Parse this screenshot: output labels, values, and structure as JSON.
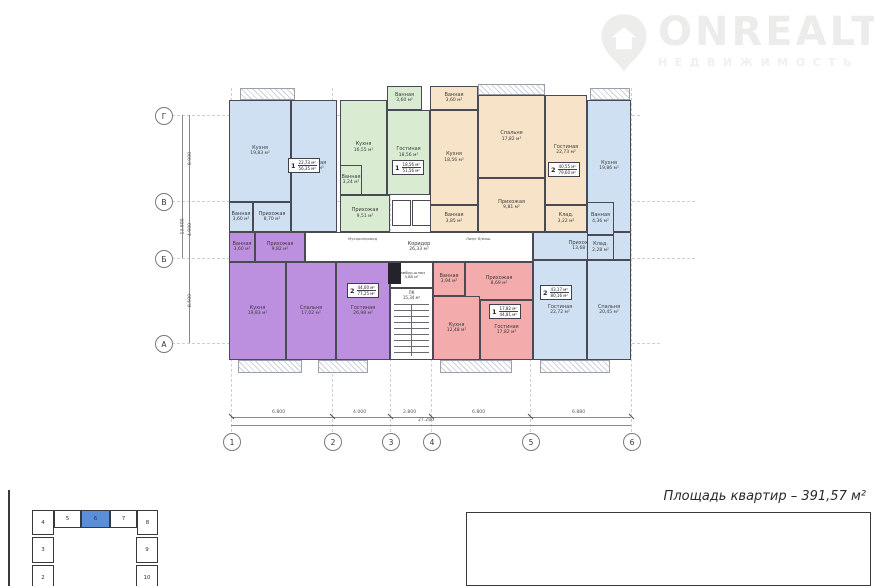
{
  "watermark": {
    "brand": "ONREALT",
    "subtitle": "НЕДВИЖИМОСТЬ",
    "color": "#ececea"
  },
  "plan": {
    "wall_color": "#4a4a55",
    "axes_cols": [
      "1",
      "2",
      "3",
      "4",
      "5",
      "6"
    ],
    "axes_rows": [
      "Г",
      "В",
      "Б",
      "А"
    ],
    "dims_bottom": [
      "6.800",
      "4.000",
      "2.800",
      "6.800",
      "6.880"
    ],
    "dim_bottom_total": "27.280",
    "dims_left": [
      "8.900",
      "4.900",
      "8.500"
    ],
    "dim_left_total": "13.800",
    "apartments": {
      "a1": {
        "color": "#cfe0f3",
        "tag": {
          "num": "1",
          "living": "22,73 м²",
          "total": "56,35 м²"
        },
        "rooms": {
          "kitchen": {
            "name": "Кухня",
            "area": "19,83 м²"
          },
          "living": {
            "name": "Гостиная",
            "area": "22,73 м²"
          },
          "hall": {
            "name": "Прихожая",
            "area": "8,70 м²"
          },
          "bath": {
            "name": "Ванная",
            "area": "3,60 м²"
          }
        }
      },
      "a2": {
        "color": "#d9ecd2",
        "tag": {
          "num": "1",
          "living": "18,56 м²",
          "total": "51,56 м²"
        },
        "rooms": {
          "bath_top": {
            "name": "Ванная",
            "area": "3,60 м²"
          },
          "kitchen": {
            "name": "Кухня",
            "area": "16,55 м²"
          },
          "living": {
            "name": "Гостиная",
            "area": "18,56 м²"
          },
          "bath": {
            "name": "Ванная",
            "area": "3,24 м²"
          },
          "hall": {
            "name": "Прихожая",
            "area": "9,51 м²"
          }
        }
      },
      "a3": {
        "color": "#f7e3c7",
        "tag": {
          "num": "2",
          "living": "40,55 м²",
          "total": "79,60 м²"
        },
        "rooms": {
          "bath_top": {
            "name": "Ванная",
            "area": "3,60 м²"
          },
          "kitchen": {
            "name": "Кухня",
            "area": "18,56 м²"
          },
          "bedroom": {
            "name": "Спальня",
            "area": "17,82 м²"
          },
          "living": {
            "name": "Гостиная",
            "area": "22,73 м²"
          },
          "hall": {
            "name": "Прихожая",
            "area": "9,81 м²"
          },
          "bath": {
            "name": "Ванная",
            "area": "3,85 м²"
          },
          "storage": {
            "name": "Клад.",
            "area": "3,22 м²"
          }
        }
      },
      "a4": {
        "color": "#cfe0f3",
        "tag": {
          "num": "2",
          "living": "43,17 м²",
          "total": "80,16 м²"
        },
        "rooms": {
          "kitchen": {
            "name": "Кухня",
            "area": "19,86 м²"
          },
          "bath": {
            "name": "Ванная",
            "area": "4,36 м²"
          },
          "storage": {
            "name": "Клад.",
            "area": "2,28 м²"
          },
          "hall": {
            "name": "Прихожая",
            "area": "13,68 м²"
          },
          "living": {
            "name": "Гостиная",
            "area": "22,72 м²"
          },
          "bedroom": {
            "name": "Спальня",
            "area": "20,45 м²"
          }
        }
      },
      "a5": {
        "color": "#bd8fdf",
        "tag": {
          "num": "2",
          "living": "44,00 м²",
          "total": "77,25 м²"
        },
        "rooms": {
          "bath": {
            "name": "Ванная",
            "area": "3,60 м²"
          },
          "hall": {
            "name": "Прихожая",
            "area": "9,82 м²"
          },
          "kitchen": {
            "name": "Кухня",
            "area": "19,83 м²"
          },
          "bedroom": {
            "name": "Спальня",
            "area": "17,02 м²"
          },
          "living": {
            "name": "Гостиная",
            "area": "26,98 м²"
          }
        }
      },
      "a6": {
        "color": "#f3abab",
        "tag": {
          "num": "1",
          "living": "17,82 м²",
          "total": "44,81 м²"
        },
        "rooms": {
          "bath": {
            "name": "Ванная",
            "area": "3,94 м²"
          },
          "hall": {
            "name": "Прихожая",
            "area": "8,69 м²"
          },
          "kitchen": {
            "name": "Кухня",
            "area": "12,48 м²"
          },
          "living": {
            "name": "Гостиная",
            "area": "17,82 м²"
          }
        }
      }
    },
    "common": {
      "corridor": {
        "name": "Коридор",
        "area": "26,33 м²"
      },
      "tambour": {
        "name": "Тамбур-шлюз",
        "area": "3,88 м²"
      },
      "stairs": {
        "name": "ЛК",
        "area": "15,34 м²"
      },
      "note_trash": "Мусоропровод",
      "note_lift": "Лифт б/маш."
    }
  },
  "keyplan": {
    "top": [
      "4",
      "5",
      "6",
      "7",
      "8"
    ],
    "left": [
      "3",
      "2"
    ],
    "right": [
      "9",
      "10"
    ],
    "active": "6",
    "active_color": "#5b8ed9"
  },
  "titleblock": {
    "area_total": "Площадь квартир – 391,57 м²",
    "doc_number": "0034/2022-АР",
    "project_line1": "Проект 16-ти этажного комплекса апартаментов,",
    "project_line2": "по адресу: РД, г. Махачкала, мкр в Юго-Восточной промзоне.",
    "type_label": "Тип - 3",
    "small_cols": [
      "Изм.",
      "Колич.",
      "Лист",
      "№док.",
      "Подп.",
      "Дата"
    ],
    "role": "Директор",
    "name": "Рустамов З.Р.",
    "stage_header": [
      "Стадия",
      "Лист",
      "Листов"
    ],
    "stage_value": "ПР"
  }
}
